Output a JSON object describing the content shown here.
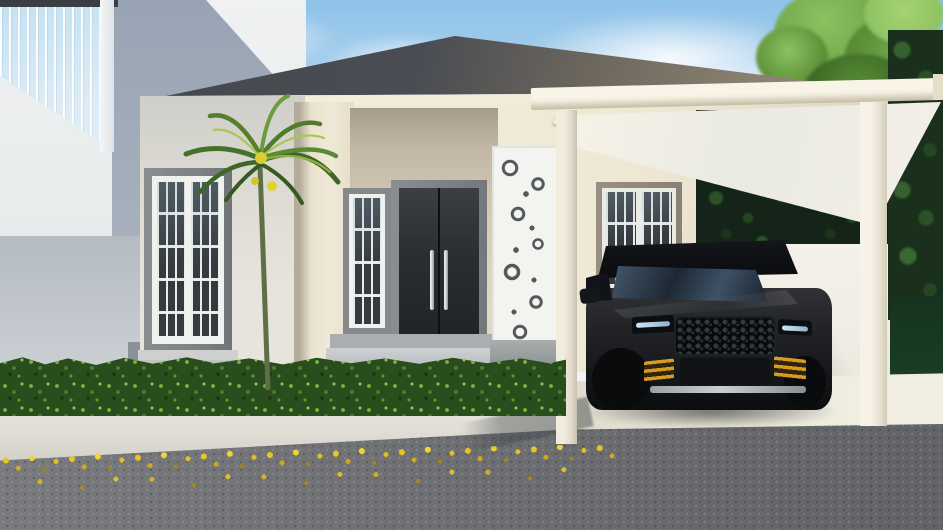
{
  "scene": {
    "type": "architectural-render",
    "description": "Daytime 3D exterior render of a modern single-story hip-roof house with cream walls, dark double entry door, ornamental carved column, palm tree, white carport with translucent roof sheltering a black SUV, green hedge, sidewalk with fallen yellow leaves and asphalt road in the foreground; taller white neighbor building at left and dense green trees at right.",
    "objects": [
      "sky",
      "clouds",
      "tree-canopy",
      "neighbor-building",
      "curtain-wall-window",
      "garden-wall",
      "hip-roof",
      "roof-fascia",
      "house-wall",
      "corner-pillar",
      "porch-recess",
      "casement-window",
      "tall-window",
      "entry-door",
      "door-handles",
      "entry-step",
      "carved-ornament-panel",
      "french-window",
      "palm-tree",
      "carport-beam",
      "carport-roof-panel",
      "carport-posts",
      "carport-floor-tiles",
      "black-suv",
      "suv-grille",
      "suv-headlights",
      "suv-amber-vents",
      "white-fence-wall",
      "dark-foliage",
      "side-lawn",
      "hedge",
      "sidewalk",
      "fallen-yellow-leaves",
      "asphalt-road"
    ]
  },
  "colors": {
    "sky_top": "#8fc3e9",
    "sky_mid": "#c6def1",
    "sky_low": "#ecf3f8",
    "canopy_light": "#8cc160",
    "canopy_mid": "#6ca244",
    "canopy_dark": "#3a6423",
    "glass_blue": "#c3e1f2",
    "neighbor_shade": "#98a4b4",
    "neighbor_wall": "#e9eced",
    "garden_wall": "#b4bbc2",
    "roof_dark": "#4a4d53",
    "roof_light": "#958b7a",
    "fascia": "#f2ecd9",
    "wall_cream": "#eee7d4",
    "wall_shade": "#d8d0bd",
    "frame_gray": "#7e8285",
    "glass_dark": "#343a3e",
    "mullion": "#f0f2ef",
    "door_dark": "#2b2e32",
    "handle": "#d8dce0",
    "carve_white": "#f3f4f0",
    "carve_dark": "#53585c",
    "carport_white": "#f3eedf",
    "fence_white": "#f4f1e9",
    "foliage_dark": "#142418",
    "tree_dark": "#1b2f1d",
    "lawn_dark": "#1a3d23",
    "hedge_base": "#2a4d1e",
    "hedge_light": "#6fae35",
    "sidewalk": "#e0ddd5",
    "tile": "#e9e6da",
    "road": "#6e7073",
    "leaf_yellow": "#e8c51f",
    "car_body": "#1a1c1f",
    "car_sheen": "#303236",
    "amber": "#d89b1d",
    "led": "#cfe6f4",
    "silver": "#c9ced2",
    "palm_green": "#4e7a2c",
    "palm_light": "#a7c74e",
    "palm_yellow": "#ddd12e",
    "trunk": "#5e6f48"
  }
}
